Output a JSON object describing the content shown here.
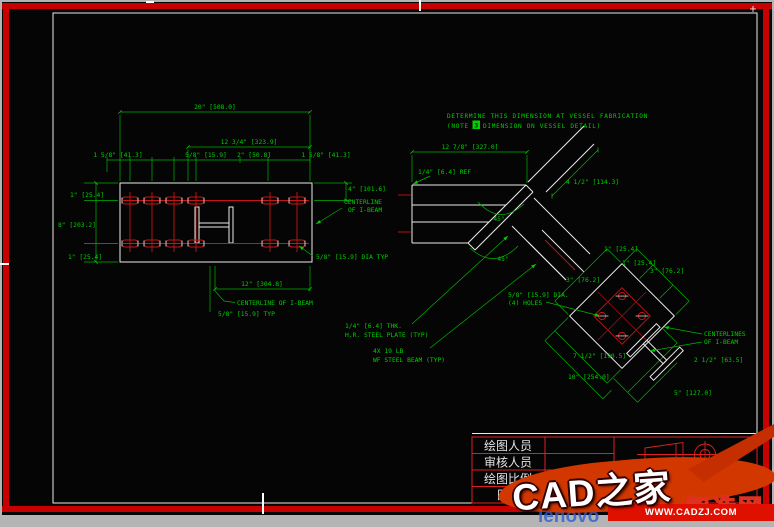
{
  "colors": {
    "dim_green": "#00cf00",
    "entity_red": "#c81414",
    "sheet_white": "#eaeaea",
    "frame_red": "#c80000",
    "title_red": "#e02020",
    "watermark_orange": "#d23700",
    "band_red": "#e01000"
  },
  "fab_note": {
    "line1": "DETERMINE THIS DIMENSION AT VESSEL FABRICATION",
    "prefix": "(NOTE",
    "num": "3",
    "suffix": "DIMENSION ON VESSEL DETAIL)"
  },
  "left_view": {
    "dim_overall": "20\" [508.0]",
    "dim_sub": "12 3/4\" [323.9]",
    "dim_r1": "1 5/8\" [41.3]",
    "dim_r2": "5/8\" [15.9]",
    "dim_r3": "2\" [50.8]",
    "dim_r4": "1 5/8\" [41.3]",
    "dim_l1": "1\" [25.4]",
    "dim_l2": "8\" [203.2]",
    "dim_l3": "1\" [25.4]",
    "dim_right": "4\" [101.6]",
    "dim_bottom": "12\" [304.8]",
    "typ_note": "5/8\" [15.9] TYP",
    "hole_note": "5/8\" [15.9] DIA TYP",
    "cl_bottom": "CENTERLINE OF I-BEAM",
    "cl_right_1": "CENTERLINE",
    "cl_right_2": "OF I-BEAM"
  },
  "middle_view": {
    "dim_top": "12 7/8\" [327.0]",
    "ref_note": "1/4\" [6.4] REF",
    "angle_a": "45°",
    "angle_b": "45°",
    "plate_note_1": "1/4\" [6.4] THK.",
    "plate_note_2": "H.R. STEEL PLATE (TYP)",
    "beam_note_1": "4X 19 LB",
    "beam_note_2": "WF STEEL BEAM (TYP)"
  },
  "right_view": {
    "dim_along": "4 1/2\" [114.3]",
    "dim_t1": "1\" [25.4]",
    "dim_t2": "1\" [25.4]",
    "dim_ur": "3\" [76.2]",
    "dim_ul": "3\" [76.2]",
    "dim_ll1": "7 1/2\" [190.5]",
    "dim_ll2": "10\" [254.0]",
    "dim_lr1": "2 1/2\" [63.5]",
    "dim_lr2": "5\" [127.0]",
    "holes_note_1": "5/8\" [15.9] DIA.",
    "holes_note_2": "(4) HOLES",
    "cl_1": "CENTERLINES",
    "cl_2": "OF I-BEAM"
  },
  "title_block": {
    "rows": [
      "绘图人员",
      "审核人员",
      "绘图比例",
      "日期"
    ],
    "company": "广州中望龙腾软件"
  },
  "watermark": {
    "brand": "CAD之家",
    "url": "WWW.CADZJ.COM",
    "bg_text_blue": "lenovo",
    "bg_text_cjk": "智造网"
  }
}
